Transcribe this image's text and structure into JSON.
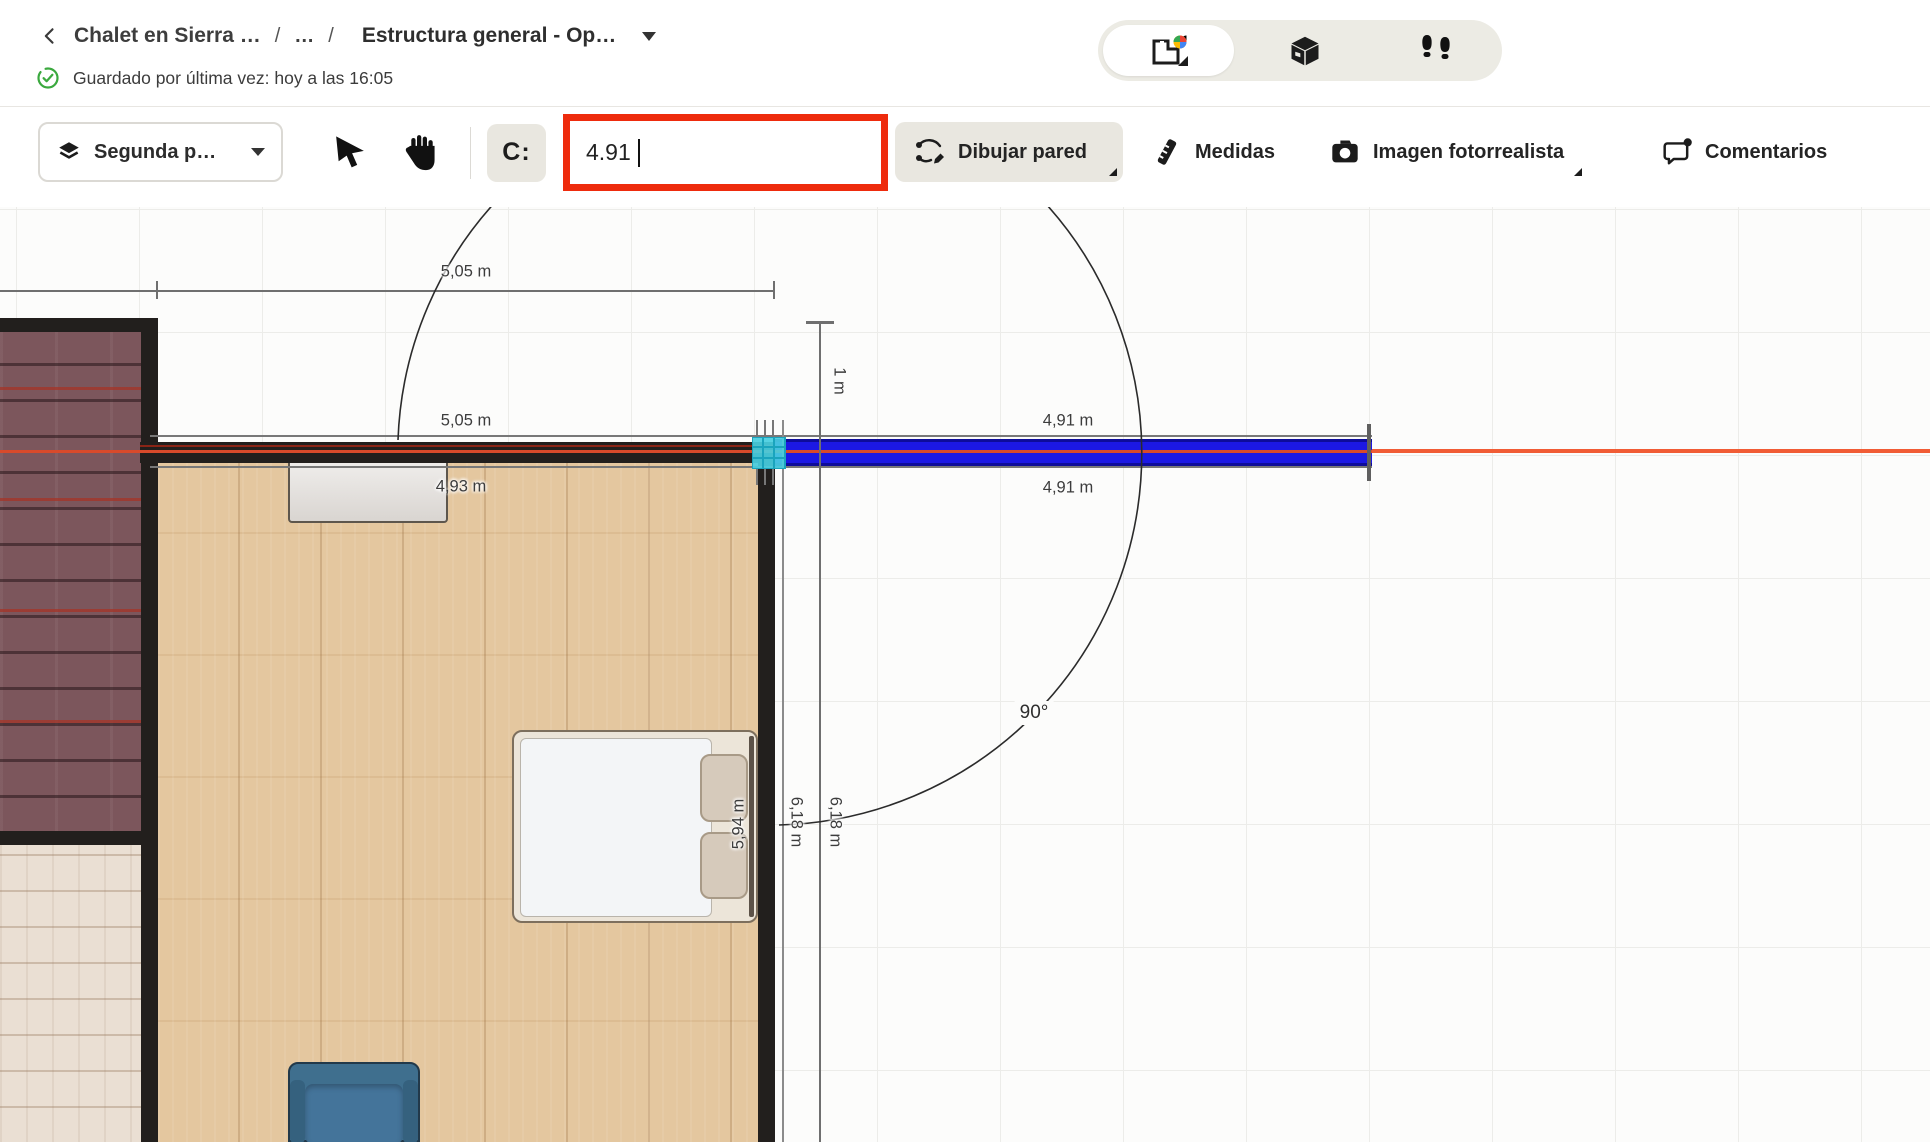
{
  "header": {
    "project_name": "Chalet en Sierra …",
    "breadcrumb_separator": "/",
    "breadcrumb_collapsed": "…",
    "design_name": "Estructura general - Op…",
    "saved_status": "Guardado por última vez: hoy a las 16:05"
  },
  "view_switcher": {
    "active_mode": "2d-plan",
    "modes": [
      "2d-plan",
      "3d-view",
      "walkthrough"
    ]
  },
  "toolbar": {
    "floor_selector_label": "Segunda p…",
    "magnet_tool_label": "C:",
    "wall_length_input": {
      "value": "4.91"
    },
    "draw_wall_label": "Dibujar pared",
    "measures_label": "Medidas",
    "photo_label": "Imagen fotorrealista",
    "comments_label": "Comentarios"
  },
  "canvas": {
    "labels": {
      "dim_top": "5,05 m",
      "dim_wall_left": "5,05 m",
      "dim_room_width": "4,93 m",
      "dim_new_wall_top": "4,91 m",
      "dim_new_wall_bottom": "4,91 m",
      "dim_offset": "1 m",
      "dim_vertical_inner": "6,18 m",
      "dim_vertical_outer": "6,18 m",
      "dim_room_height": "5,94 m",
      "angle": "90°"
    },
    "colors": {
      "new_wall_blue": "#1c18e4",
      "axis_orange": "#f15c35",
      "snap_cyan": "#48cee0",
      "highlight_red": "#ee2b0d",
      "existing_wall": "#221f1d"
    }
  }
}
